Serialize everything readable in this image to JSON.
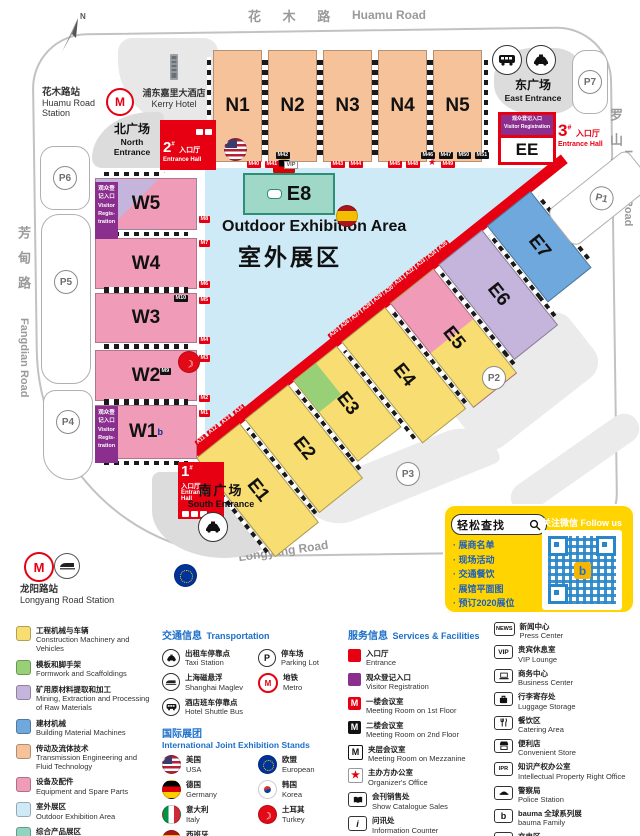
{
  "colors": {
    "accent_red": "#e60012",
    "visitor_purple": "#8b2f8f",
    "outdoor_blue": "#cfeaf7",
    "hall_yellow": "#f7dd72",
    "hall_pink": "#f09cb8",
    "hall_peach": "#f6c29a",
    "hall_lavender": "#c5b5dc",
    "hall_blue": "#6fa8dc",
    "hall_teal": "#8fd4bf",
    "legend_blue": "#1c6fc8",
    "infobox_yellow": "#ffd400"
  },
  "compass": {
    "n": "N"
  },
  "roads": {
    "top_cn": "花 木 路",
    "top_en": "Huamu Road",
    "left_cn": "芳甸路",
    "left_en": "Fangdian Road",
    "right_cn": "罗山路",
    "right_en": "Luoshan Road",
    "bottom_cn": "龙 阳 路",
    "bottom_en": "Longyang Road"
  },
  "stations": {
    "huamu_cn": "花木路站",
    "huamu_en1": "Huamu Road",
    "huamu_en2": "Station",
    "longyang_cn": "龙阳路站",
    "longyang_en": "Longyang Road Station"
  },
  "landmarks": {
    "kerry_cn": "浦东嘉里大酒店",
    "kerry_en": "Kerry Hotel"
  },
  "plazas": {
    "north_cn": "北广场",
    "north_en1": "North",
    "north_en2": "Entrance",
    "east_cn": "东广场",
    "east_en": "East Entrance",
    "south_cn": "南广场",
    "south_en": "South Entrance"
  },
  "entrance_halls": {
    "no1": "1",
    "no2": "2",
    "no3": "3",
    "hash": "#",
    "cn": "入口厅",
    "en": "Entrance Hall",
    "en1": "Entrance",
    "en2": "Hall"
  },
  "visitor_reg": {
    "cn1": "观众登",
    "cn2": "记入口",
    "en1": "Visitor",
    "en2": "Regis-",
    "en3": "tration",
    "line_cn": "观众登记入口",
    "line_en": "Visitor Registration"
  },
  "outdoor": {
    "en": "Outdoor Exhibition Area",
    "cn": "室外展区"
  },
  "halls": {
    "n1": "N1",
    "n2": "N2",
    "n3": "N3",
    "n4": "N4",
    "n5": "N5",
    "w1": "W1",
    "w1_sup": "b",
    "w2": "W2",
    "w3": "W3",
    "w4": "W4",
    "w5": "W5",
    "e1": "E1",
    "e2": "E2",
    "e3": "E3",
    "e4": "E4",
    "e5": "E5",
    "e6": "E6",
    "e7": "E7",
    "e8": "E8",
    "ee": "EE"
  },
  "parking": {
    "p1": "P1",
    "p2": "P2",
    "p3": "P3",
    "p4": "P4",
    "p5": "P5",
    "p6": "P6",
    "p7": "P7"
  },
  "gates": {
    "n_black": [
      "M42",
      "M46",
      "M47",
      "M50",
      "M51"
    ],
    "n_red": [
      "M40",
      "M41",
      "M43",
      "M44",
      "M45",
      "M48",
      "M49"
    ],
    "vip": "VIP",
    "w_red": [
      "M8",
      "M7",
      "M6",
      "M5",
      "M4",
      "M3",
      "M2",
      "M1"
    ],
    "w_black": [
      "M10",
      "M9"
    ],
    "diag_red": [
      "A11",
      "A12",
      "A13",
      "A14",
      "A25",
      "A26",
      "A27",
      "A28",
      "A29",
      "A30",
      "A31",
      "A32",
      "A33",
      "A34",
      "A35"
    ]
  },
  "infobox": {
    "search": "轻松查找",
    "follow": "关注微信 Follow us",
    "items": [
      "· 展商名单",
      "· 现场活动",
      "· 交通餐饮",
      "· 展馆平面图",
      "· 预订2020展位"
    ]
  },
  "legend": {
    "categories": [
      {
        "cn": "工程机械与车辆",
        "en": "Construction Machinery and Vehicles",
        "color": "#f7dd72"
      },
      {
        "cn": "模板和脚手架",
        "en": "Formwork and Scaffoldings",
        "color": "#97d077"
      },
      {
        "cn": "矿用原材料提取和加工",
        "en": "Mining, Extraction and Processing of Raw Materials",
        "color": "#c5b5dc"
      },
      {
        "cn": "建材机械",
        "en": "Building Material Machines",
        "color": "#6fa8dc"
      },
      {
        "cn": "传动及流体技术",
        "en": "Transmission Engineering and Fluid Technology",
        "color": "#f6c29a"
      },
      {
        "cn": "设备及配件",
        "en": "Equipment and Spare Parts",
        "color": "#f09cb8"
      },
      {
        "cn": "室外展区",
        "en": "Outdoor Exhibition Area",
        "color": "#cfeaf7"
      },
      {
        "cn": "综合产品展区",
        "en": "Integrated Products",
        "color": "#8fd4bf"
      }
    ],
    "transport": {
      "title_cn": "交通信息",
      "title_en": "Transportation",
      "taxi_cn": "出租车停靠点",
      "taxi_en": "Taxi Station",
      "parking_cn": "停车场",
      "parking_en": "Parking Lot",
      "parking_p": "P",
      "maglev_cn": "上海磁悬浮",
      "maglev_en": "Shanghai Maglev",
      "metro_cn": "地铁",
      "metro_en": "Metro",
      "bus_cn": "酒店班车停靠点",
      "bus_en": "Hotel Shuttle Bus"
    },
    "intl": {
      "title_cn": "国际展团",
      "title_en": "International Joint Exhibition Stands",
      "usa_cn": "美国",
      "usa_en": "USA",
      "eu_cn": "欧盟",
      "eu_en": "European",
      "ger_cn": "德国",
      "ger_en": "Germany",
      "kor_cn": "韩国",
      "kor_en": "Korea",
      "ita_cn": "意大利",
      "ita_en": "Italy",
      "tur_cn": "土耳其",
      "tur_en": "Turkey",
      "esp_cn": "西班牙",
      "esp_en": "Spain"
    },
    "services": {
      "title_cn": "服务信息",
      "title_en": "Services & Facilities",
      "m": "M",
      "star": "★",
      "i": "i",
      "items": [
        {
          "cn": "入口厅",
          "en": "Entrance"
        },
        {
          "cn": "观众登记入口",
          "en": "Visitor Registration"
        },
        {
          "cn": "一楼会议室",
          "en": "Meeting Room on 1st Floor"
        },
        {
          "cn": "二楼会议室",
          "en": "Meeting Room on 2nd Floor"
        },
        {
          "cn": "夹层会议室",
          "en": "Meeting Room on Mezzanine"
        },
        {
          "cn": "主办方办公室",
          "en": "Organizer's Office"
        },
        {
          "cn": "会刊销售处",
          "en": "Show Catalogue Sales"
        },
        {
          "cn": "问讯处",
          "en": "Information Counter"
        },
        {
          "cn": "bauma CHINA纪念品店",
          "en": "bauma CHINA Shop"
        }
      ]
    },
    "facilities": {
      "news": "NEWS",
      "vip": "VIP",
      "ipr": "IPR",
      "b": "b",
      "items": [
        {
          "cn": "新闻中心",
          "en": "Press Center"
        },
        {
          "cn": "贵宾休息室",
          "en": "VIP Lounge"
        },
        {
          "cn": "商务中心",
          "en": "Business Center"
        },
        {
          "cn": "行李寄存处",
          "en": "Luggage Storage"
        },
        {
          "cn": "餐饮区",
          "en": "Catering Area"
        },
        {
          "cn": "便利店",
          "en": "Convenient Store"
        },
        {
          "cn": "知识产权办公室",
          "en": "Intellectual Property Right Office"
        },
        {
          "cn": "警察局",
          "en": "Police Station"
        },
        {
          "cn": "bauma 全球系列展",
          "en": "bauma Family"
        },
        {
          "cn": "充电区",
          "en": "Charging Area"
        }
      ]
    }
  }
}
